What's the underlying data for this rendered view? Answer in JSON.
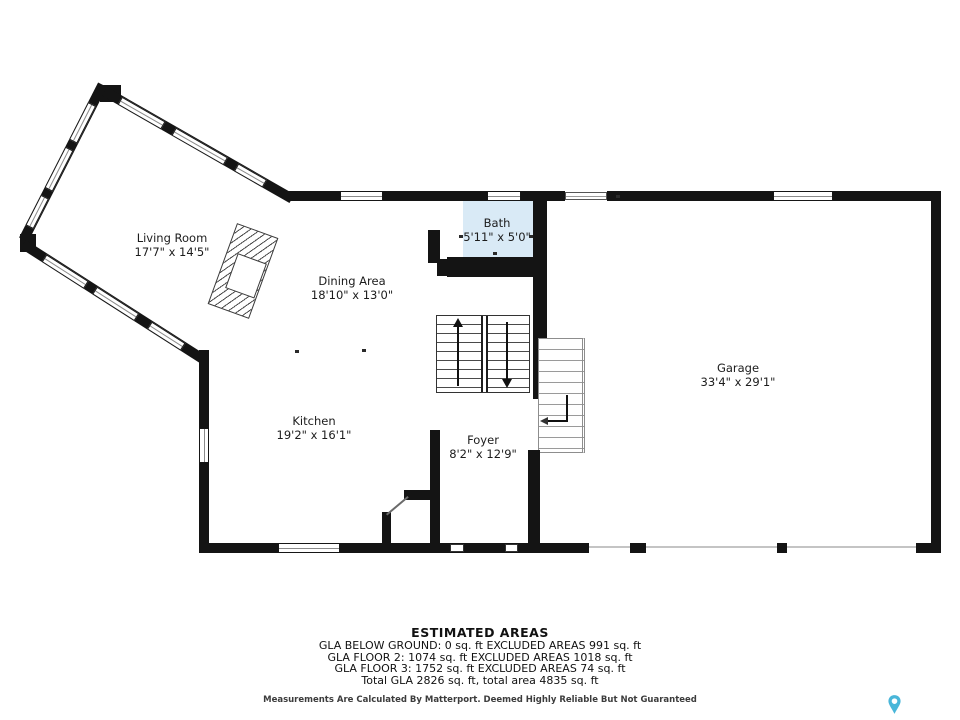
{
  "plan": {
    "type": "floor-plan",
    "floor": "main",
    "colors": {
      "wall": "#141414",
      "bath_fill": "#d9eaf6",
      "window_midline": "#8a8a8a",
      "pin_blue": "#49b6d9"
    }
  },
  "rooms": [
    {
      "name": "Living Room",
      "dims": "17'7\" x 14'5\""
    },
    {
      "name": "Dining Area",
      "dims": "18'10\" x 13'0\""
    },
    {
      "name": "Bath",
      "dims": "5'11\" x 5'0\""
    },
    {
      "name": "Kitchen",
      "dims": "19'2\" x 16'1\""
    },
    {
      "name": "Foyer",
      "dims": "8'2\" x 12'9\""
    },
    {
      "name": "Garage",
      "dims": "33'4\" x 29'1\""
    }
  ],
  "estimated_areas": {
    "title": "ESTIMATED AREAS",
    "lines": [
      "GLA BELOW GROUND: 0 sq. ft EXCLUDED AREAS 991 sq. ft",
      "GLA FLOOR 2: 1074 sq. ft EXCLUDED AREAS 1018 sq. ft",
      "GLA FLOOR 3: 1752 sq. ft EXCLUDED AREAS 74 sq. ft",
      "Total GLA 2826 sq. ft, total area 4835 sq. ft"
    ],
    "disclaimer": "Measurements Are Calculated By Matterport. Deemed Highly Reliable But Not Guaranteed"
  },
  "icons": {
    "pin": "matterport-location-pin"
  }
}
